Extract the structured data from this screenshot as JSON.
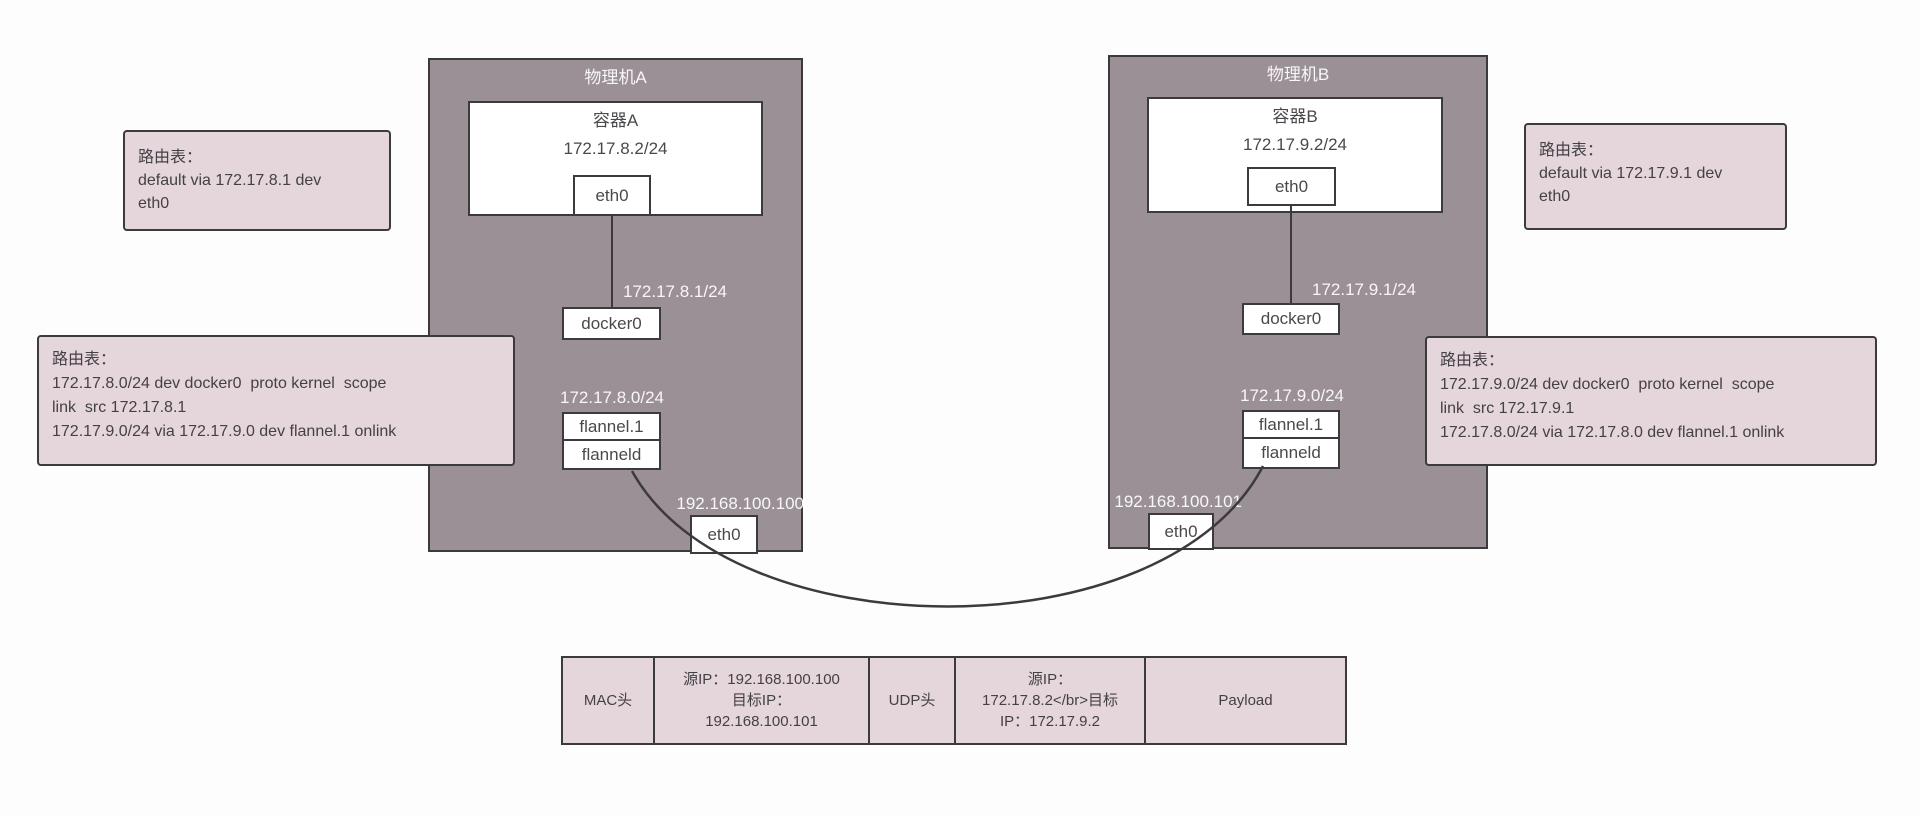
{
  "colors": {
    "host_fill": "#9a9096",
    "note_fill": "#e5d6dc",
    "border": "#3b3a3e",
    "label_on_host": "#f8f6f8",
    "text": "#4a484c"
  },
  "machine_a": {
    "title": "物理机A",
    "container": {
      "title": "容器A",
      "ip": "172.17.8.2/24",
      "eth": "eth0"
    },
    "bridge_ip": "172.17.8.1/24",
    "bridge": "docker0",
    "overlay_subnet": "172.17.8.0/24",
    "vtep": "flannel.1",
    "daemon": "flanneld",
    "host_ip": "192.168.100.100",
    "nic": "eth0"
  },
  "machine_b": {
    "title": "物理机B",
    "container": {
      "title": "容器B",
      "ip": "172.17.9.2/24",
      "eth": "eth0"
    },
    "bridge_ip": "172.17.9.1/24",
    "bridge": "docker0",
    "overlay_subnet": "172.17.9.0/24",
    "vtep": "flannel.1",
    "daemon": "flanneld",
    "host_ip": "192.168.100.101",
    "nic": "eth0"
  },
  "route_tables": {
    "a_default": {
      "title": "路由表：",
      "lines": [
        "default via 172.17.8.1 dev",
        "eth0"
      ]
    },
    "a_host": {
      "title": "路由表：",
      "lines": [
        "172.17.8.0/24 dev docker0  proto kernel  scope",
        "link  src 172.17.8.1",
        "172.17.9.0/24 via 172.17.9.0 dev flannel.1 onlink"
      ]
    },
    "b_default": {
      "title": "路由表：",
      "lines": [
        "default via 172.17.9.1 dev",
        "eth0"
      ]
    },
    "b_host": {
      "title": "路由表：",
      "lines": [
        "172.17.9.0/24 dev docker0  proto kernel  scope",
        "link  src 172.17.9.1",
        "172.17.8.0/24 via 172.17.8.0 dev flannel.1 onlink"
      ]
    }
  },
  "packet": {
    "cells": [
      {
        "lines": [
          "MAC头"
        ]
      },
      {
        "lines": [
          "源IP：192.168.100.100",
          "目标IP：",
          "192.168.100.101"
        ]
      },
      {
        "lines": [
          "UDP头"
        ]
      },
      {
        "lines": [
          "源IP：",
          "172.17.8.2</br>目标",
          "IP：172.17.9.2"
        ]
      },
      {
        "lines": [
          "Payload"
        ]
      }
    ]
  }
}
